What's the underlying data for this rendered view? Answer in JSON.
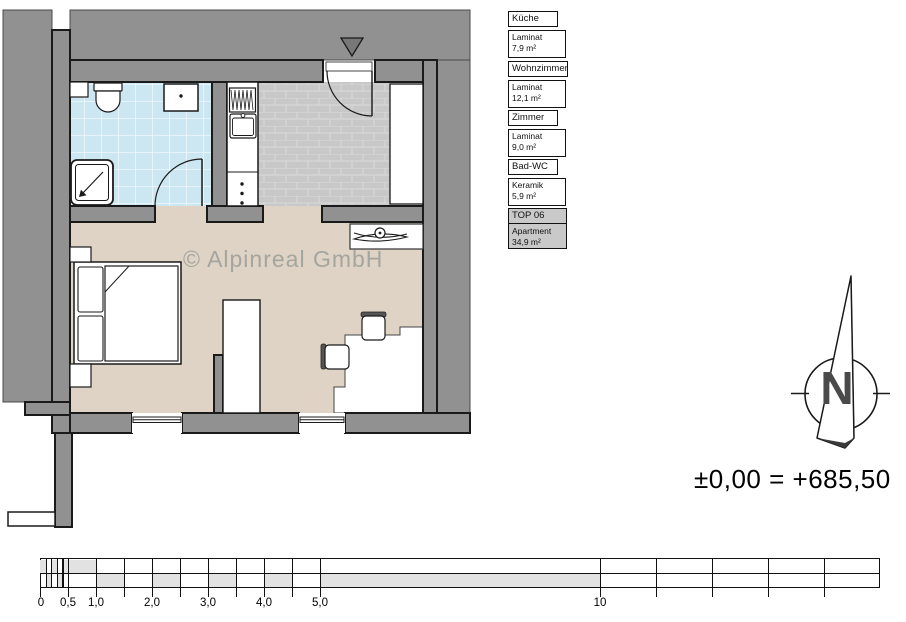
{
  "legend": {
    "items": [
      {
        "title": "Küche",
        "material": "Laminat",
        "area": "7,9  m²"
      },
      {
        "title": "Wohnzimmer",
        "material": "Laminat",
        "area": "12,1  m²"
      },
      {
        "title": "Zimmer",
        "material": "Laminat",
        "area": "9,0  m²"
      },
      {
        "title": "Bad-WC",
        "material": "Keramik",
        "area": "5,9  m²"
      },
      {
        "title": "TOP  06",
        "material": "Apartment",
        "area": "34,9  m²"
      }
    ]
  },
  "watermark": {
    "text": "© Alpinreal GmbH"
  },
  "compass": {
    "label": "N"
  },
  "elevation": {
    "text": "±0,00 = +685,50"
  },
  "scale_bar": {
    "labels": [
      "0",
      "0,5",
      "1,0",
      "2,0",
      "3,0",
      "4,0",
      "5,0",
      "10"
    ]
  },
  "colors": {
    "wall_gray": "#919191",
    "bathroom_tile": "#cde7f2",
    "kitchen_tile": "#c8c8c8",
    "floor_beige": "#ded3c4",
    "legend_highlight": "#c9c9c9"
  }
}
